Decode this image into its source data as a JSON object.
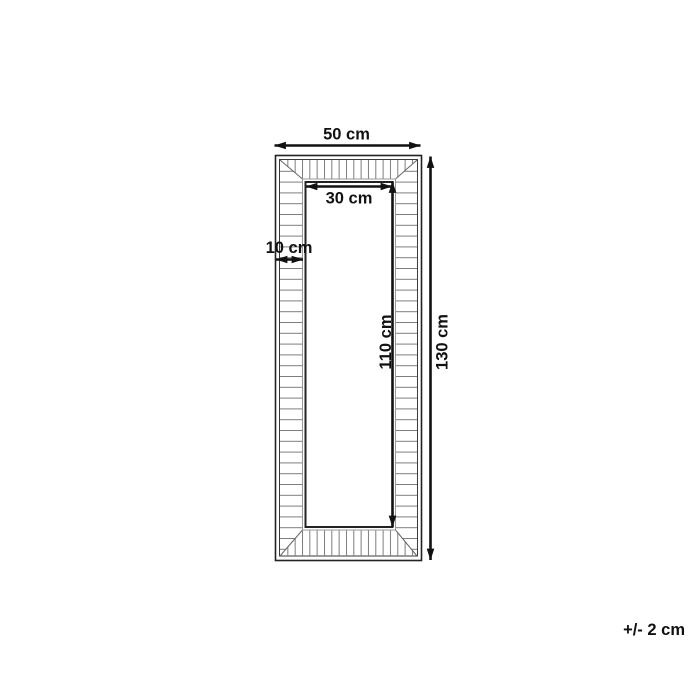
{
  "diagram": {
    "kind": "mirror-frame-dimension-drawing",
    "dimensions": {
      "outer_width": "50 cm",
      "inner_width": "30 cm",
      "frame_depth": "10 cm",
      "inner_height": "110 cm",
      "outer_height": "130 cm"
    },
    "tolerance": "+/- 2 cm"
  },
  "colors": {
    "ink": "#111111",
    "line": "#222222",
    "hatch": "#7d7d7d",
    "miter": "#666666",
    "edge": "#999999",
    "bg": "#ffffff"
  }
}
